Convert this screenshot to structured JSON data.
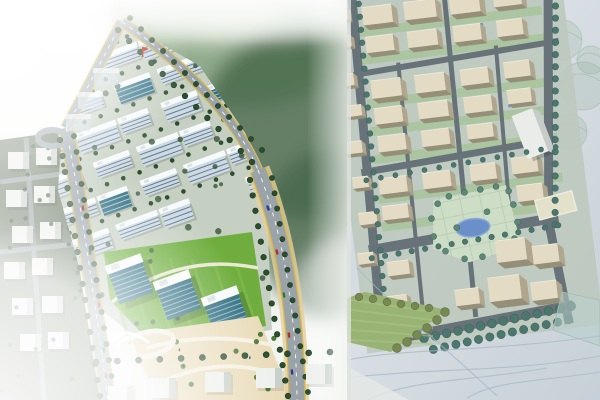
{
  "title": "Aerial rendering and physical scale model of a master-planned building development, side by side",
  "panels": {
    "left": {
      "label": "3D aerial rendering",
      "description": "Bird's-eye computer rendering: rows of white mid-rise buildings with blue window bands on a diagonal street grid, tree-lined boulevard with yellow edge lines and cars, bright green lawns with three blue glass office slabs, sandy plaza with curved paths and a traffic circle with a white gateway sculpture, faded white context blocks at the edges, blurred green forest backdrop, small red flagpole at the top of the site.",
      "width": 347
    },
    "right": {
      "label": "Physical scale model photo",
      "description": "Photograph of a foam site model: rows of beige massing blocks on a slightly tilted grid, dark grey loop roads edged with teal model trees, small blue courtyard pools, a central park with an oval blue pond, a white tower slab, a cream paved pad, a hand-coloured green lawn wedge with olive tree rows, all on a pale blue-grey drawing-board base with pencil sketch lines.",
      "width": 253
    }
  },
  "palette": {
    "render": {
      "fog": "#f7f9f6",
      "forest_dark": "#4a6a4e",
      "forest_mid": "#7d9b77",
      "forest_light": "#b9cbb0",
      "ground": "#c6d0c2",
      "context_ground": "#65745d",
      "face": "#cddae3",
      "window": "#3c5a74",
      "roof": "#f7fafb",
      "glass": "#2f6e82",
      "glass_stripe": "#cfe6ee",
      "lawn": "#6fae3e",
      "lawn_light": "#83bd50",
      "road": "#9aa4a8",
      "yellow": "#d9b94e",
      "sand_shoulder": "#e3cf9a",
      "tree": "#2c4d2f",
      "plaza": "#e9dcba",
      "path": "#f5f0e2",
      "red": "#c03018",
      "context_box": "#edf0ec",
      "context_side": "#c9cfc9"
    },
    "model": {
      "base": "#c7d1d8",
      "base_light": "#dbe1e6",
      "ground": "#bdc9bb",
      "block_top": "#e7ddc1",
      "block_side": "#ada184",
      "block_dark": "#8f876c",
      "road": "#5c676d",
      "tree": "#3c6b60",
      "tree_edge": "#2e564c",
      "alley": "#9fc28b",
      "park": "#cfe0c4",
      "park_line": "#b2c7aa",
      "pond": "#5f87c6",
      "pond_edge": "#82a5d8",
      "wedge": "#92b066",
      "olive": "#6d7f40",
      "olive_edge": "#59692f",
      "tower": "#eff1ec",
      "tower_side": "#c8ccc6",
      "pad": "#e8e4c9",
      "sketch": "#9fb4c0",
      "scribble": "#8aa98f",
      "paved": "#b7cfc9"
    }
  },
  "scene": {
    "render": {
      "site_clip": "62,132 120,20 200,66 246,134 268,230 272,330 150,348 88,300 58,190",
      "forest_blobs": [
        [
          238,
          42,
          118,
          66
        ],
        [
          305,
          125,
          105,
          95
        ],
        [
          195,
          8,
          85,
          38
        ],
        [
          330,
          235,
          70,
          85
        ]
      ],
      "campus_grid": {
        "rows": 6,
        "cols": 5,
        "x0": 42,
        "y0": 44,
        "dx": 46,
        "dy": 33,
        "rot": -20,
        "cx": 150,
        "cy": 160
      },
      "lawn_poly": "104,252 252,232 266,326 152,344 110,300",
      "plaza_poly": "130,334 258,316 286,384 292,400 160,400 140,362",
      "glass_buildings": [
        [
          128,
          278
        ],
        [
          176,
          294
        ],
        [
          224,
          310
        ]
      ],
      "boulevard": "M66,128 C80,200 92,280 108,400",
      "top_road": "M66,128 L122,22",
      "perimeter_road": "M122,22 C180,60 235,115 258,170",
      "arterial_road": "M258,170 C280,225 296,300 297,400",
      "loop_center": [
        52,
        138
      ],
      "roundabout": [
        148,
        344
      ],
      "flag": [
        142,
        47
      ],
      "cars_boulevard": [
        [
          83,
          208,
          "#b03028",
          81
        ],
        [
          90,
          252,
          "#2c6e2c",
          81
        ],
        [
          99,
          305,
          "#b03028",
          82
        ],
        [
          104,
          350,
          "#1e7a30",
          83
        ],
        [
          106,
          376,
          "#952a28",
          84
        ]
      ],
      "cars_arterial": [
        [
          268,
          208,
          "#2a3a9a",
          70
        ],
        [
          277,
          252,
          "#b03028",
          74
        ],
        [
          284,
          295,
          "#2c7a2c",
          80
        ],
        [
          289,
          335,
          "#b03028",
          83
        ],
        [
          292,
          372,
          "#2a3a9a",
          85
        ]
      ],
      "context_boxes": [
        [
          8,
          152
        ],
        [
          36,
          148
        ],
        [
          6,
          190
        ],
        [
          34,
          186
        ],
        [
          12,
          226
        ],
        [
          40,
          222
        ],
        [
          4,
          262
        ],
        [
          32,
          258
        ],
        [
          12,
          298
        ],
        [
          42,
          296
        ],
        [
          20,
          334
        ],
        [
          48,
          332
        ]
      ],
      "bottom_boxes": [
        [
          150,
          378
        ],
        [
          205,
          372
        ],
        [
          256,
          368
        ],
        [
          306,
          364
        ],
        [
          108,
          386
        ]
      ],
      "top_boxes": [
        [
          78,
          96
        ],
        [
          94,
          72
        ],
        [
          66,
          118
        ]
      ]
    },
    "model": {
      "site_rot": -7,
      "site_cx": 120,
      "site_cy": 180,
      "blocks": [
        [
          36,
          -4,
          30,
          18
        ],
        [
          78,
          -4,
          32,
          18
        ],
        [
          124,
          -4,
          30,
          18
        ],
        [
          168,
          -4,
          28,
          16
        ],
        [
          36,
          26,
          28,
          16
        ],
        [
          78,
          26,
          30,
          16
        ],
        [
          124,
          26,
          28,
          16
        ],
        [
          168,
          26,
          26,
          16
        ],
        [
          36,
          70,
          30,
          18
        ],
        [
          80,
          70,
          30,
          18
        ],
        [
          126,
          70,
          28,
          16
        ],
        [
          170,
          68,
          26,
          16
        ],
        [
          36,
          98,
          28,
          16
        ],
        [
          80,
          98,
          30,
          16
        ],
        [
          126,
          98,
          28,
          16
        ],
        [
          170,
          96,
          24,
          14
        ],
        [
          36,
          126,
          28,
          16
        ],
        [
          80,
          126,
          28,
          16
        ],
        [
          126,
          126,
          26,
          14
        ],
        [
          32,
          168,
          28,
          16
        ],
        [
          76,
          168,
          28,
          16
        ],
        [
          124,
          166,
          26,
          16
        ],
        [
          166,
          164,
          26,
          16
        ],
        [
          32,
          196,
          26,
          14
        ],
        [
          168,
          192,
          26,
          16
        ],
        [
          140,
          244,
          30,
          22
        ],
        [
          176,
          254,
          26,
          18
        ],
        [
          128,
          280,
          32,
          24
        ],
        [
          170,
          290,
          26,
          18
        ],
        [
          94,
          288,
          24,
          16
        ],
        [
          30,
          252,
          22,
          14
        ],
        [
          26,
          286,
          20,
          13
        ],
        [
          4,
          -6,
          18,
          12
        ],
        [
          6,
          22,
          16,
          11
        ],
        [
          2,
          60,
          18,
          12
        ],
        [
          8,
          92,
          16,
          11
        ],
        [
          2,
          128,
          18,
          12
        ],
        [
          6,
          164,
          16,
          11
        ],
        [
          8,
          200,
          18,
          12
        ],
        [
          2,
          240,
          16,
          11
        ]
      ],
      "pools": [
        [
          62,
          2
        ],
        [
          110,
          2
        ],
        [
          150,
          26
        ],
        [
          94,
          26
        ],
        [
          58,
          72
        ],
        [
          140,
          72
        ],
        [
          104,
          100
        ],
        [
          170,
          100
        ],
        [
          62,
          128
        ],
        [
          130,
          170
        ],
        [
          90,
          198
        ]
      ],
      "roads": [
        [
          "M28,-15 L16,335",
          9
        ],
        [
          "M225,-10 L196,232",
          9
        ],
        [
          "M196,232 L204,335",
          9
        ],
        [
          "M20,62 L228,53",
          6
        ],
        [
          "M16,160 L212,150",
          7
        ],
        [
          "M14,238 L206,228",
          10
        ],
        [
          "M10,330 L210,317",
          10
        ],
        [
          "M120,-10 L112,317",
          5
        ],
        [
          "M66,55 L60,317",
          4
        ],
        [
          "M165,50 L158,228",
          4
        ]
      ],
      "tree_lines": [
        [
          [
            34,
            -8
          ],
          [
            22,
            330
          ],
          13,
          2.8
        ],
        [
          [
            232,
            -6
          ],
          [
            202,
            235
          ],
          12,
          3.2
        ],
        [
          [
            20,
            168
          ],
          [
            212,
            158
          ],
          14,
          2.5
        ],
        [
          [
            16,
            246
          ],
          [
            205,
            236
          ],
          13,
          2.7
        ],
        [
          [
            58,
            332
          ],
          [
            208,
            318
          ],
          11,
          4.4
        ],
        [
          [
            66,
            344
          ],
          [
            204,
            331
          ],
          11,
          4.1
        ]
      ],
      "park_poly": "84,196 158,190 166,252 112,262 78,244",
      "park_pond": [
        120,
        228,
        17,
        9
      ],
      "park_trees": [
        [
          88,
          200
        ],
        [
          100,
          194
        ],
        [
          116,
          192
        ],
        [
          132,
          191
        ],
        [
          148,
          190
        ],
        [
          160,
          196
        ],
        [
          163,
          210
        ],
        [
          165,
          228
        ],
        [
          160,
          244
        ],
        [
          144,
          252
        ],
        [
          126,
          258
        ],
        [
          108,
          258
        ],
        [
          90,
          248
        ],
        [
          80,
          232
        ],
        [
          80,
          214
        ],
        [
          104,
          226
        ],
        [
          136,
          214
        ]
      ],
      "small_pond": [
        52,
        318,
        8
      ],
      "tower": [
        172,
        122,
        22,
        46
      ],
      "pad": [
        186,
        206,
        38,
        20
      ],
      "wedge_poly": "0,298 18,292 100,310 44,352 0,342",
      "wedge_trees_a": [
        [
          98,
          312
        ],
        [
          90,
          320
        ],
        [
          80,
          328
        ],
        [
          70,
          335
        ],
        [
          60,
          342
        ],
        [
          50,
          348
        ]
      ],
      "wedge_trees_b": [
        [
          12,
          297
        ],
        [
          26,
          299
        ],
        [
          40,
          302
        ],
        [
          54,
          304
        ],
        [
          68,
          306
        ],
        [
          82,
          308
        ]
      ],
      "scribbles": [
        [
          215,
          40,
          20
        ],
        [
          236,
          86,
          24
        ],
        [
          222,
          132,
          18
        ],
        [
          244,
          60,
          14
        ]
      ],
      "sketch_paths": [
        "M0,360 C60,348 140,352 253,336",
        "M0,378 C80,368 170,372 253,356",
        "M20,400 C70,378 120,382 200,368",
        "M120,398 C150,380 190,382 253,372",
        "M10,268 C40,300 90,340 150,396"
      ],
      "paved_poly": "215,292 253,300 253,346 206,330"
    }
  }
}
